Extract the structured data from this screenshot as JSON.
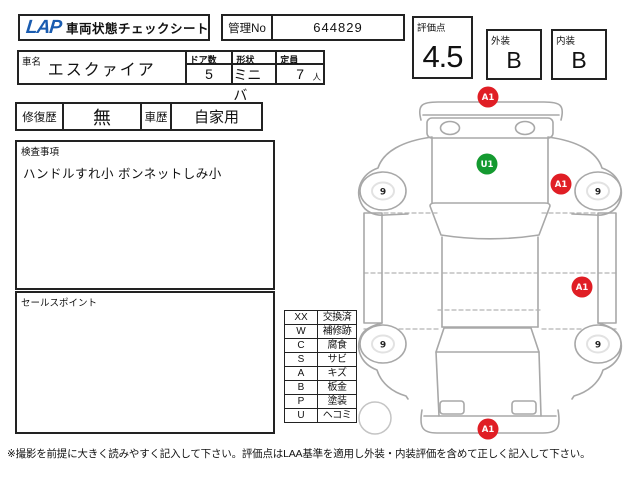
{
  "sheet": {
    "logo": "LAP",
    "title": "車両状態チェックシート",
    "kanri_label": "管理No",
    "kanri_no": "644829",
    "score_label": "評価点",
    "score": "4.5",
    "exterior_label": "外装",
    "exterior_grade": "B",
    "interior_label": "内装",
    "interior_grade": "B"
  },
  "vehicle": {
    "name_label": "車名",
    "name": "エスクァイア",
    "doors_label": "ドア数",
    "doors": "5",
    "shape_label": "形状",
    "shape": "ミニバ",
    "capacity_label": "定員",
    "capacity": "7",
    "capacity_unit": "人"
  },
  "history": {
    "repair_label": "修復歴",
    "repair": "無",
    "use_label": "車歴",
    "use": "自家用"
  },
  "inspection": {
    "label": "検査事項",
    "notes": "ハンドルすれ小 ボンネットしみ小"
  },
  "sales_point": {
    "label": "セールスポイント",
    "notes": ""
  },
  "legend": {
    "rows": [
      {
        "code": "XX",
        "label": "交換済"
      },
      {
        "code": "W",
        "label": "補修跡"
      },
      {
        "code": "C",
        "label": "腐食"
      },
      {
        "code": "S",
        "label": "サビ"
      },
      {
        "code": "A",
        "label": "キズ"
      },
      {
        "code": "B",
        "label": "板金"
      },
      {
        "code": "P",
        "label": "塗装"
      },
      {
        "code": "U",
        "label": "ヘコミ"
      }
    ]
  },
  "footer_note": "※撮影を前提に大きく読みやすく記入して下さい。評価点はLAA基準を適用し外装・内装評価を含めて正しく記入して下さい。",
  "diagram": {
    "markers": [
      {
        "code": "A1",
        "color": "#e01e25",
        "x": 138,
        "y": 15,
        "location": "front-bumper"
      },
      {
        "code": "U1",
        "color": "#149a30",
        "x": 137,
        "y": 82,
        "location": "hood"
      },
      {
        "code": "A1",
        "color": "#e01e25",
        "x": 211,
        "y": 102,
        "location": "right-front-fender"
      },
      {
        "code": "A1",
        "color": "#e01e25",
        "x": 232,
        "y": 205,
        "location": "right-rear-panel"
      },
      {
        "code": "A1",
        "color": "#e01e25",
        "x": 138,
        "y": 347,
        "location": "rear-bumper"
      }
    ],
    "tires": [
      {
        "depth": "9",
        "x": 33,
        "y": 109,
        "location": "front-left"
      },
      {
        "depth": "9",
        "x": 248,
        "y": 109,
        "location": "front-right"
      },
      {
        "depth": "9",
        "x": 33,
        "y": 262,
        "location": "rear-left"
      },
      {
        "depth": "9",
        "x": 248,
        "y": 262,
        "location": "rear-right"
      }
    ]
  },
  "colors": {
    "logo_blue": "#1a5cb0",
    "marker_red": "#e01e25",
    "marker_green": "#149a30",
    "outline_gray": "#a8a8a8"
  }
}
